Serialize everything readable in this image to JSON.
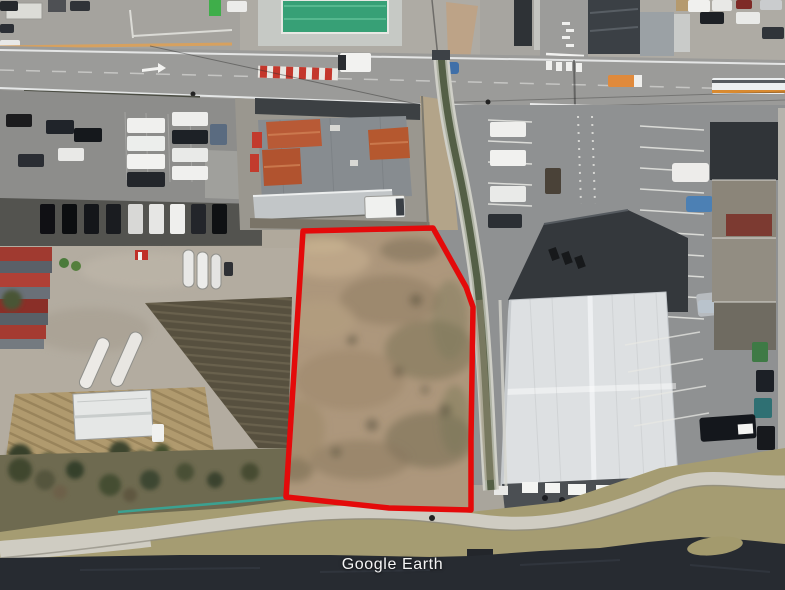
{
  "watermark": {
    "text": "Google Earth"
  },
  "annotation": {
    "outline_color": "#e40a0a"
  },
  "palette": {
    "road": "#9b9b99",
    "right_asphalt": "#8f9192",
    "left_asphalt": "#8d8d8b",
    "dirt_lot": "#ad977c",
    "canal_water": "#545f46",
    "river_water": "#272b31",
    "warehouse_roof": "#dde0e2",
    "dark_roof": "#34383c",
    "tile_roof": "#b85a36",
    "pool_water": "#37a076",
    "embankment_concrete": "#cfccc2",
    "field_soil": "#57503f",
    "bank_grass": "#a59c72"
  }
}
